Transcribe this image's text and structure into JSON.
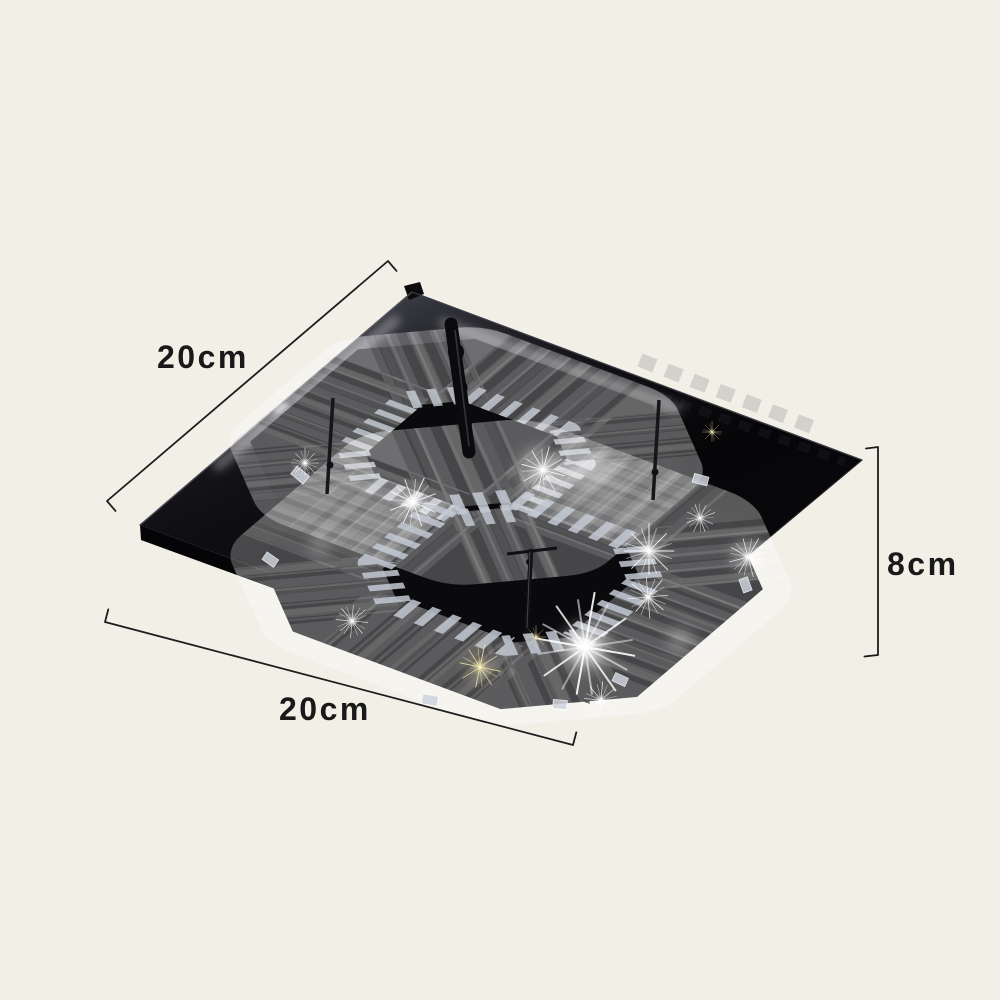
{
  "scene": {
    "background_color": "#f2efe7",
    "subject": "two-tier square crystal LED flush-mount ceiling lamp on a black mirrored square canopy, lit with white sparkles",
    "canopy_color": "#0b0b0d",
    "crystal_color": "#d7dce4",
    "glow_color": "#ffffff",
    "warm_sparkle_color": "#f5e7ab"
  },
  "annotations": {
    "line_color": "#1d1d1d",
    "dim_top_left": "20cm",
    "dim_bottom": "20cm",
    "dim_right": "8cm"
  }
}
